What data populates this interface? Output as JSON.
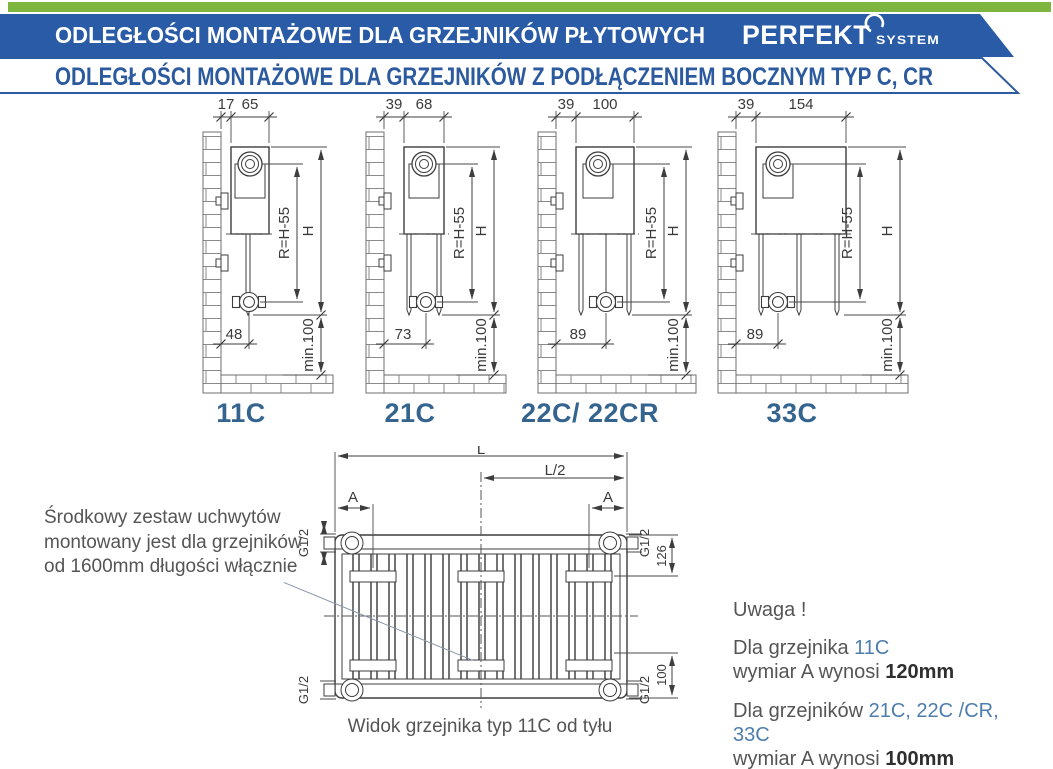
{
  "header": {
    "title": "ODLEGŁOŚCI MONTAŻOWE DLA GRZEJNIKÓW PŁYTOWYCH",
    "brand": "PERFEKT",
    "brand_sub": "SYSTEM",
    "subtitle": "ODLEGŁOŚCI MONTAŻOWE DLA GRZEJNIKÓW Z PODŁĄCZENIEM BOCZNYM TYP C, CR"
  },
  "colors": {
    "green_bar": "#7eb53e",
    "banner_blue": "#2a5ba6",
    "heading_blue": "#2b5a9f",
    "label_blue": "#35648f",
    "accent_blue": "#4d7dac"
  },
  "dim_labels": {
    "r": "R=H-55",
    "h": "H",
    "min": "min.100"
  },
  "diagrams": [
    {
      "label": "11C",
      "gap": "17",
      "depth": "65",
      "bottom": "48"
    },
    {
      "label": "21C",
      "gap": "39",
      "depth": "68",
      "bottom": "73"
    },
    {
      "label": "22C/ 22CR",
      "gap": "39",
      "depth": "100",
      "bottom": "89"
    },
    {
      "label": "33C",
      "gap": "39",
      "depth": "154",
      "bottom": "89"
    }
  ],
  "rear": {
    "l": "L",
    "l2": "L/2",
    "a": "A",
    "g12": "G1/2",
    "d126": "126",
    "d100": "100",
    "caption": "Widok grzejnika typ 11C od tyłu"
  },
  "notes": {
    "left": {
      "line1": "Środkowy zestaw uchwytów",
      "line2": "montowany jest dla grzejników",
      "line3": "od 1600mm długości włącznie"
    },
    "uwaga": {
      "title": "Uwaga !",
      "p1a": "Dla grzejnika ",
      "p1b": "11C",
      "p2a": "wymiar A wynosi ",
      "p2b": "120mm",
      "p3a": "Dla grzejników ",
      "p3b": "21C, 22C /CR, 33C",
      "p4a": "wymiar A wynosi ",
      "p4b": "100mm"
    }
  }
}
